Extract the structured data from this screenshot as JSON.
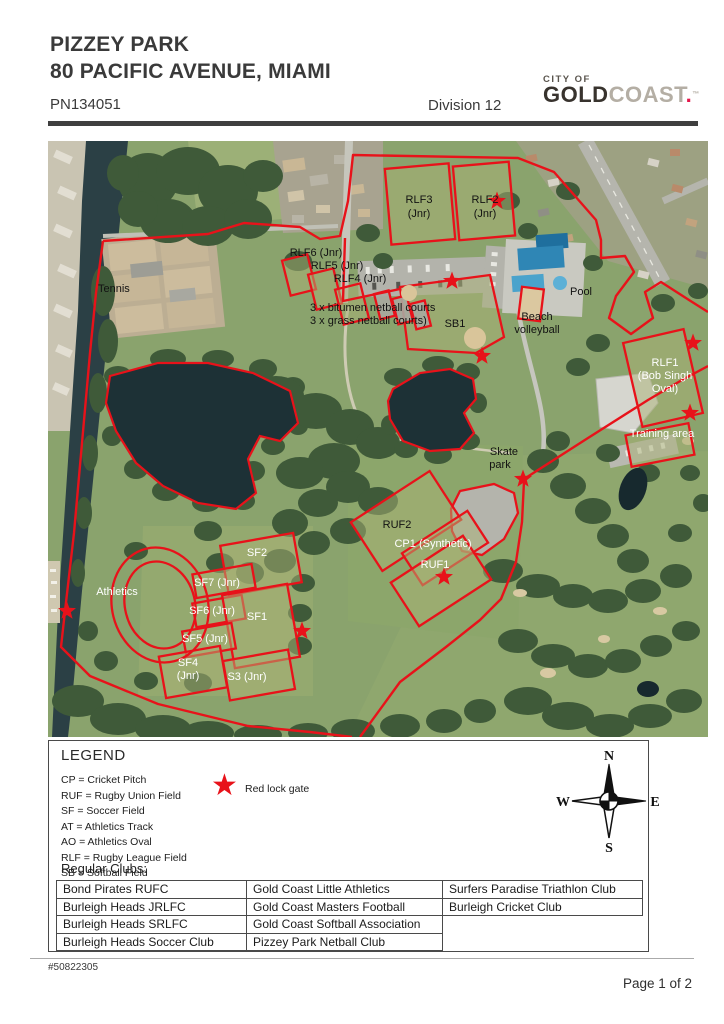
{
  "header": {
    "title": "PIZZEY PARK",
    "subtitle": "80 PACIFIC AVENUE, MIAMI",
    "plan_number": "PN134051",
    "division": "Division 12",
    "logo": {
      "city_of": "CITY OF",
      "gold": "GOLD",
      "coast": "COAST",
      "dot": ".",
      "tm": "™"
    }
  },
  "map": {
    "outline_color": "#e8121a",
    "star_color": "#e8121a",
    "labels": [
      {
        "text": "Tennis",
        "x": 50,
        "y": 151,
        "color": "dark",
        "anchor": "start"
      },
      {
        "text": "RLF3",
        "x": 371,
        "y": 62,
        "color": "dark"
      },
      {
        "text": "(Jnr)",
        "x": 371,
        "y": 76,
        "color": "dark"
      },
      {
        "text": "RLF2",
        "x": 437,
        "y": 62,
        "color": "dark"
      },
      {
        "text": "(Jnr)",
        "x": 437,
        "y": 76,
        "color": "dark"
      },
      {
        "text": "RLF6 (Jnr)",
        "x": 268,
        "y": 115,
        "color": "dark"
      },
      {
        "text": "RLF5 (Jnr)",
        "x": 289,
        "y": 128,
        "color": "dark"
      },
      {
        "text": "RLF4 (Jnr)",
        "x": 312,
        "y": 141,
        "color": "dark"
      },
      {
        "text": "3 x bitumen netball courts",
        "x": 262,
        "y": 170,
        "color": "dark",
        "anchor": "start"
      },
      {
        "text": "3 x grass netball  courts)",
        "x": 262,
        "y": 183,
        "color": "dark",
        "anchor": "start"
      },
      {
        "text": "SB1",
        "x": 407,
        "y": 186,
        "color": "dark"
      },
      {
        "text": "Pool",
        "x": 533,
        "y": 154,
        "color": "dark"
      },
      {
        "text": "Beach",
        "x": 489,
        "y": 179,
        "color": "dark"
      },
      {
        "text": "volleyball",
        "x": 489,
        "y": 192,
        "color": "dark"
      },
      {
        "text": "RLF1",
        "x": 617,
        "y": 225,
        "color": "white"
      },
      {
        "text": "(Bob Singh",
        "x": 617,
        "y": 238,
        "color": "white"
      },
      {
        "text": "Oval)",
        "x": 617,
        "y": 251,
        "color": "white"
      },
      {
        "text": "Training area",
        "x": 614,
        "y": 296,
        "color": "white"
      },
      {
        "text": "Skate",
        "x": 456,
        "y": 314,
        "color": "dark"
      },
      {
        "text": "park",
        "x": 452,
        "y": 327,
        "color": "dark"
      },
      {
        "text": "RUF2",
        "x": 349,
        "y": 387,
        "color": "dark"
      },
      {
        "text": "CP1 (Synthetic)",
        "x": 385,
        "y": 406,
        "color": "white"
      },
      {
        "text": "RUF1",
        "x": 387,
        "y": 427,
        "color": "white"
      },
      {
        "text": "Athletics",
        "x": 69,
        "y": 454,
        "color": "white"
      },
      {
        "text": "SF2",
        "x": 209,
        "y": 415,
        "color": "white"
      },
      {
        "text": "SF7 (Jnr)",
        "x": 169,
        "y": 445,
        "color": "white"
      },
      {
        "text": "SF6 (Jnr)",
        "x": 164,
        "y": 473,
        "color": "white"
      },
      {
        "text": "SF1",
        "x": 209,
        "y": 479,
        "color": "white"
      },
      {
        "text": "SF5 (Jnr)",
        "x": 157,
        "y": 501,
        "color": "white"
      },
      {
        "text": "SF4",
        "x": 140,
        "y": 525,
        "color": "white"
      },
      {
        "text": "(Jnr)",
        "x": 140,
        "y": 538,
        "color": "white"
      },
      {
        "text": "S3 (Jnr)",
        "x": 199,
        "y": 539,
        "color": "white"
      }
    ],
    "stars": [
      {
        "x": 449,
        "y": 60
      },
      {
        "x": 404,
        "y": 140
      },
      {
        "x": 434,
        "y": 215
      },
      {
        "x": 645,
        "y": 202
      },
      {
        "x": 642,
        "y": 272
      },
      {
        "x": 475,
        "y": 338
      },
      {
        "x": 396,
        "y": 436
      },
      {
        "x": 19,
        "y": 470
      },
      {
        "x": 254,
        "y": 490
      }
    ]
  },
  "legend": {
    "title": "LEGEND",
    "items": [
      "CP = Cricket Pitch",
      "RUF = Rugby Union Field",
      "SF = Soccer Field",
      "AT = Athletics Track",
      "AO = Athletics Oval",
      "RLF = Rugby League Field",
      "SB = Softball Field"
    ],
    "star_glyph": "★",
    "star_label": "Red lock gate",
    "compass": {
      "n": "N",
      "s": "S",
      "e": "E",
      "w": "W"
    }
  },
  "clubs": {
    "heading": "Regular Clubs:",
    "rows": [
      [
        "Bond Pirates RUFC",
        "Gold Coast Little Athletics",
        "Surfers Paradise Triathlon Club"
      ],
      [
        "Burleigh Heads JRLFC",
        "Gold Coast Masters Football",
        "Burleigh Cricket Club"
      ],
      [
        "Burleigh Heads SRLFC",
        "Gold Coast Softball Association",
        null
      ],
      [
        "Burleigh Heads Soccer Club",
        "Pizzey Park Netball Club",
        null
      ]
    ]
  },
  "footer": {
    "reference": "#50822305",
    "page": "Page 1 of 2"
  }
}
